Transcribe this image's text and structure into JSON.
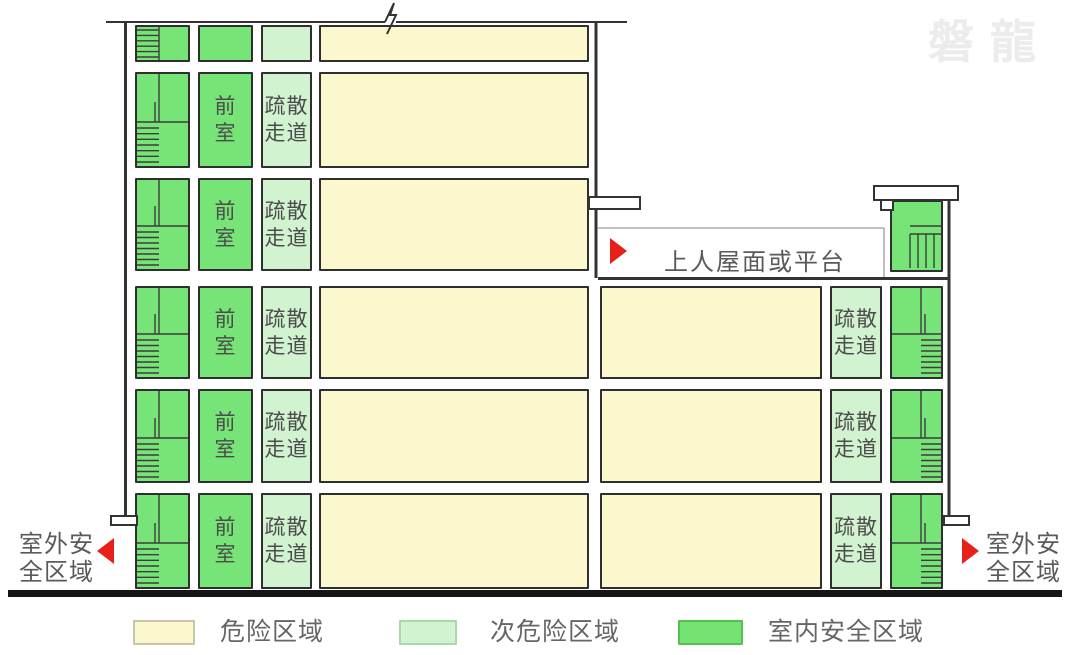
{
  "watermark": "磐龍",
  "cells": {
    "front_room_lines": [
      "前",
      "室"
    ],
    "corridor_lines": [
      "疏散",
      "走道"
    ]
  },
  "annotations": {
    "platform_label": "上人屋面或平台",
    "outdoor_left_lines": [
      "室外安",
      "全区域"
    ],
    "outdoor_right_lines": [
      "室外安",
      "全区域"
    ]
  },
  "legend": [
    {
      "label": "危险区域",
      "color": "#faf8cc",
      "border": "#c6c6aa"
    },
    {
      "label": "次危险区域",
      "color": "#d2f3d0",
      "border": "#a9d9a9"
    },
    {
      "label": "室内安全区域",
      "color": "#74e374",
      "border": "#54c054"
    }
  ],
  "colors": {
    "danger_fill": "#faf8cc",
    "sub_danger_fill": "#d2f3d0",
    "safe_fill": "#76e476",
    "cell_border": "#2f2f2f",
    "stair_line": "#3d3d3d",
    "wall": "#333333",
    "thin_line": "#9c9c9c",
    "ground": "#151515",
    "arrow_red": "#e72119",
    "cell_text": "#4c4c4c",
    "annotation_text": "#5a5a5a",
    "legend_text": "#666666",
    "watermark_color": "#ececec"
  }
}
